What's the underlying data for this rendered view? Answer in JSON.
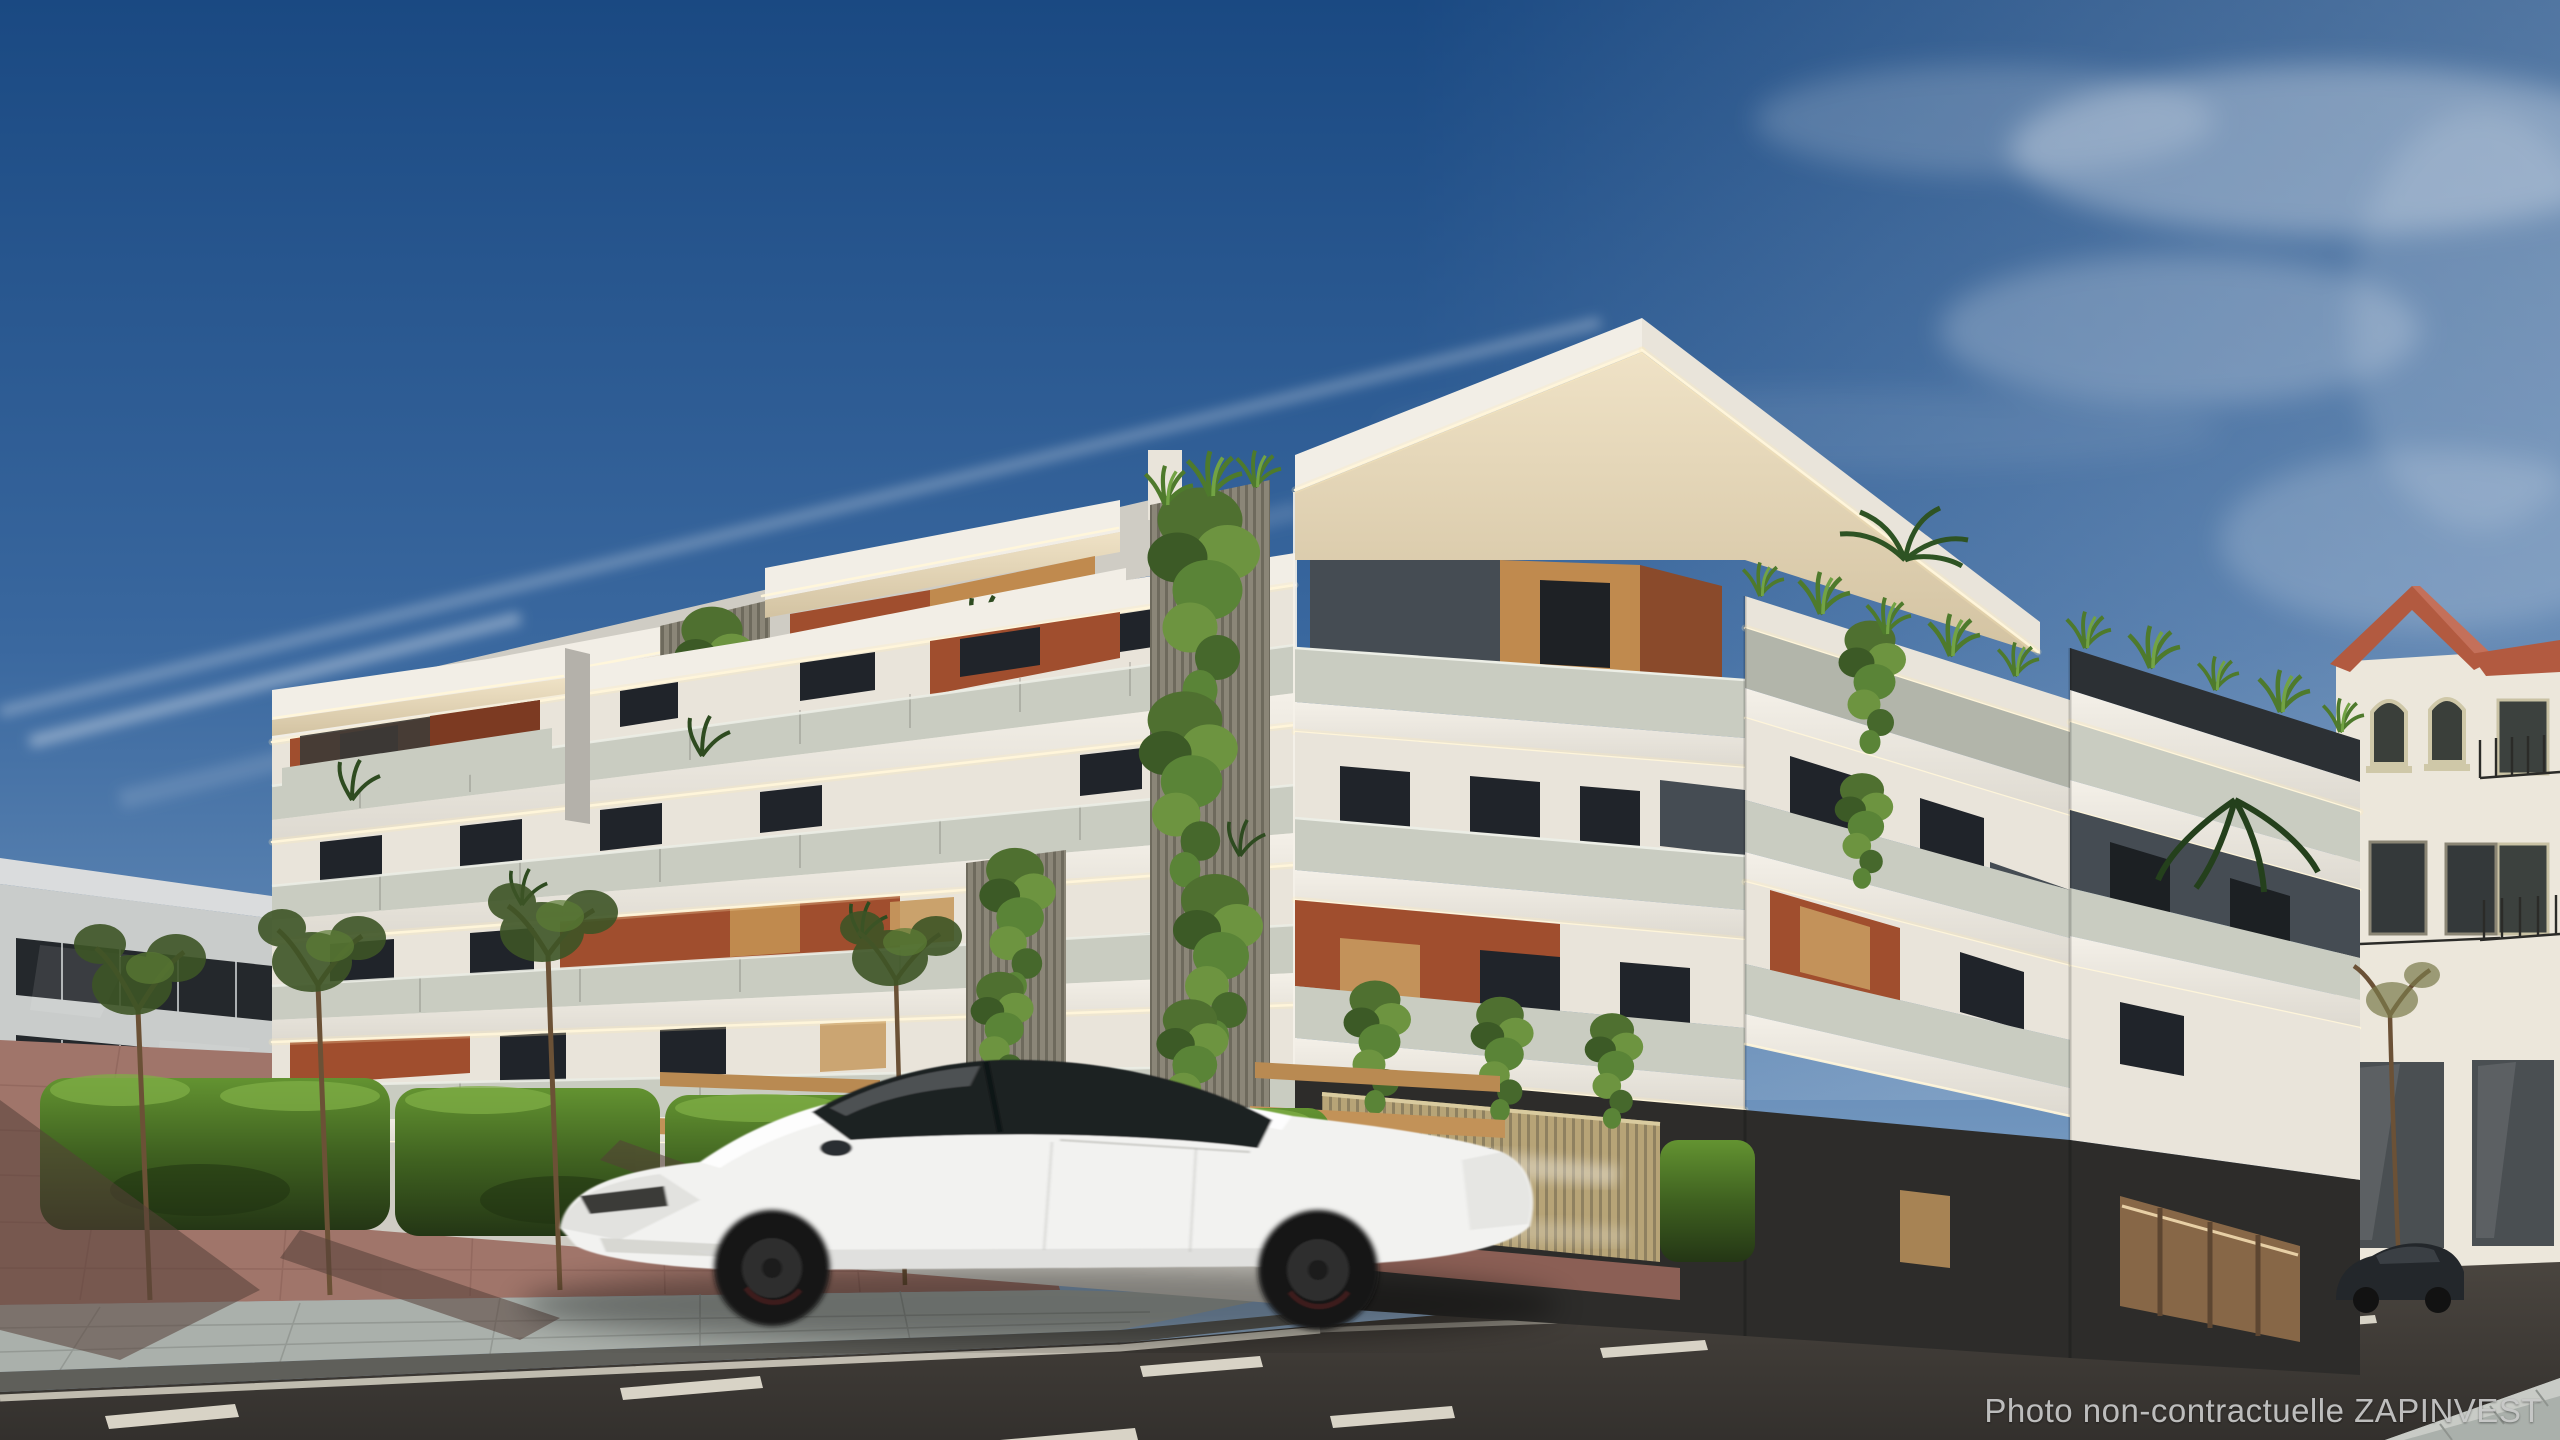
{
  "image": {
    "kind": "architectural exterior render (non-contractual promotional visual)",
    "width_px": 2560,
    "height_px": 1440,
    "scene_objects": [
      "blue-sky-with-contrail-and-wispy-clouds",
      "modern-white-apartment-building-with-led-lit-cantilever-balconies",
      "terracotta-accent-walls",
      "wood-panel-accents",
      "glass-balustrades",
      "vertical-garden-ivy-cascades",
      "rooftop-grasses-and-palm",
      "left-background-apartment-building",
      "right-background-traditional-building-terracotta-roof",
      "street-with-dashed-lane-markings",
      "red-paved-plaza-and-grey-sidewalk",
      "hedgerow-benches-and-young-trees",
      "wood-slat-fence",
      "white-sedan-car-motion-blur",
      "dark-parked-car"
    ]
  },
  "watermark": {
    "text": "Photo non-contractuelle ZAPINVEST",
    "color": "#c9c9c9"
  },
  "palette": {
    "sky-top": "#1a4982",
    "sky-mid": "#3a689f",
    "sky-low": "#93b2d0",
    "cloud": "#e8eef5",
    "white-sun": "#f2eee6",
    "white-lit": "#e9e4da",
    "white-shade": "#cfccc4",
    "white-dark": "#b4b1aa",
    "cream": "#e6d8bc",
    "cream-dark": "#d2c2a4",
    "slate": "#454c53",
    "slate-dark": "#2c3034",
    "terracotta": "#a04e2e",
    "terracotta-dark": "#7c3a22",
    "wood": "#c08a4e",
    "wood-light": "#d2a265",
    "corten": "#8a4a2b",
    "slat": "#8b8678",
    "slat-dark": "#6e6a5d",
    "darkbase": "#2d2c2a",
    "glass": "#c9ccc1",
    "glass-dark": "#b2b5aa",
    "hedge": "#4a7327",
    "hedge-dark": "#2a3f17",
    "hedge-light": "#6fa03c",
    "trunk": "#6b5136",
    "road": "#3a3633",
    "road-light": "#474239",
    "dash": "#d8d3c6",
    "plaza": "#a0756a",
    "plaza-shadow": "#553f38",
    "sidewalk": "#aab0ab",
    "curb": "#5f5f5a",
    "bg-wall": "#c9cccb",
    "bg-roof": "#dadcdd",
    "bg-window": "#24282c",
    "r-wall": "#ece7db",
    "r-roof": "#b25a40",
    "r-window": "#3c413e",
    "car-body": "#f2f2f0",
    "car-glass": "#1d2023",
    "led": "#fff6da",
    "watermark": "#c9c9c9"
  }
}
